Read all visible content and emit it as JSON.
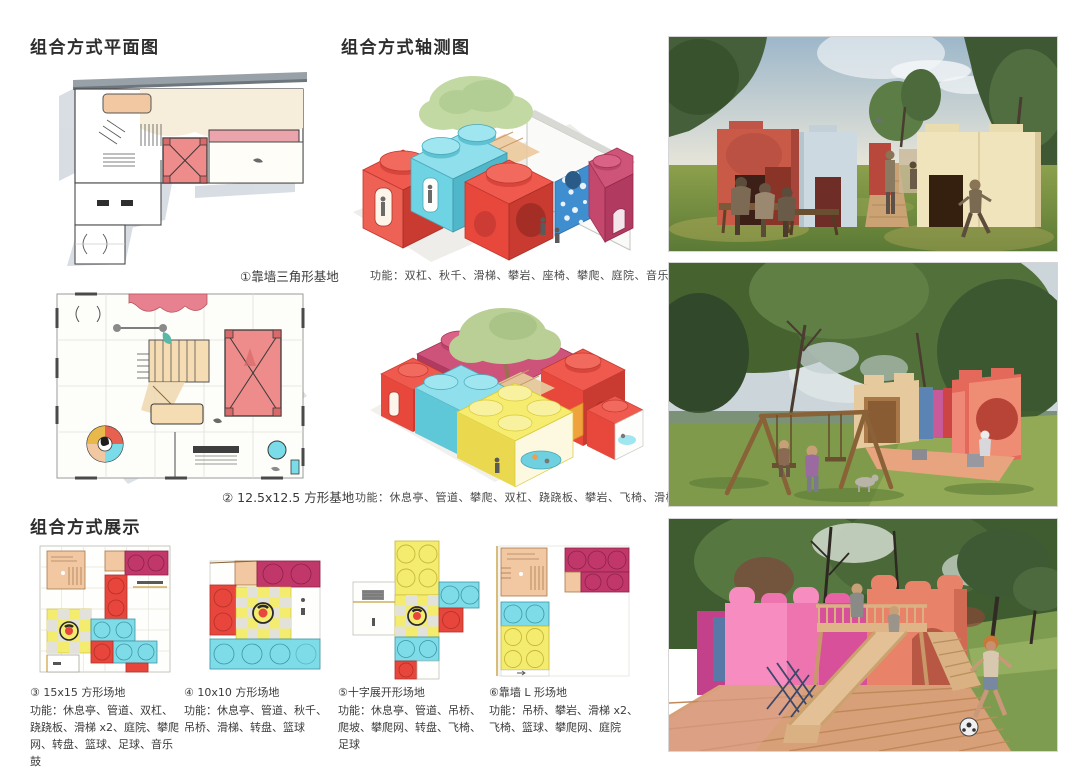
{
  "sections": {
    "plan": {
      "title": "组合方式平面图",
      "items": [
        {
          "caption": "①靠墙三角形基地"
        },
        {
          "caption": "② 12.5x12.5 方形基地"
        }
      ]
    },
    "axon": {
      "title": "组合方式轴测图",
      "items": [
        {
          "functions": "功能：双杠、秋千、滑梯、攀岩、座椅、攀爬、庭院、音乐鼓"
        },
        {
          "functions": "功能：休息亭、管道、攀爬、双杠、跷跷板、攀岩、飞椅、滑梯、庭院、足球"
        }
      ]
    },
    "display": {
      "title": "组合方式展示",
      "items": [
        {
          "caption": "③ 15x15 方形场地",
          "functions": "功能：休息亭、管道、双杠、跷跷板、滑梯 x2、庭院、攀爬网、转盘、篮球、足球、音乐鼓"
        },
        {
          "caption": "④ 10x10 方形场地",
          "functions": "功能：休息亭、管道、秋千、吊桥、滑梯、转盘、篮球"
        },
        {
          "caption": "⑤十字展开形场地",
          "functions": "功能：休息亭、管道、吊桥、爬坡、攀爬网、转盘、飞椅、足球"
        },
        {
          "caption": "⑥靠墙 L 形场地",
          "functions": "功能：吊桥、攀岩、滑梯 x2、飞椅、篮球、攀爬网、庭院"
        }
      ]
    }
  },
  "palette": {
    "lego_red": "#e8463c",
    "lego_cyan": "#7edce8",
    "lego_magenta": "#c23a6e",
    "lego_yellow": "#f4ec6e",
    "lego_orange_peach": "#f3c9a4",
    "lego_pink": "#ee74b0",
    "plan_room_red": "#ee8b8b",
    "plan_cream": "#f6eedb",
    "render_coral": "#e4695a",
    "render_grass": "#7e9a4a",
    "text": "#3a3a3a"
  }
}
